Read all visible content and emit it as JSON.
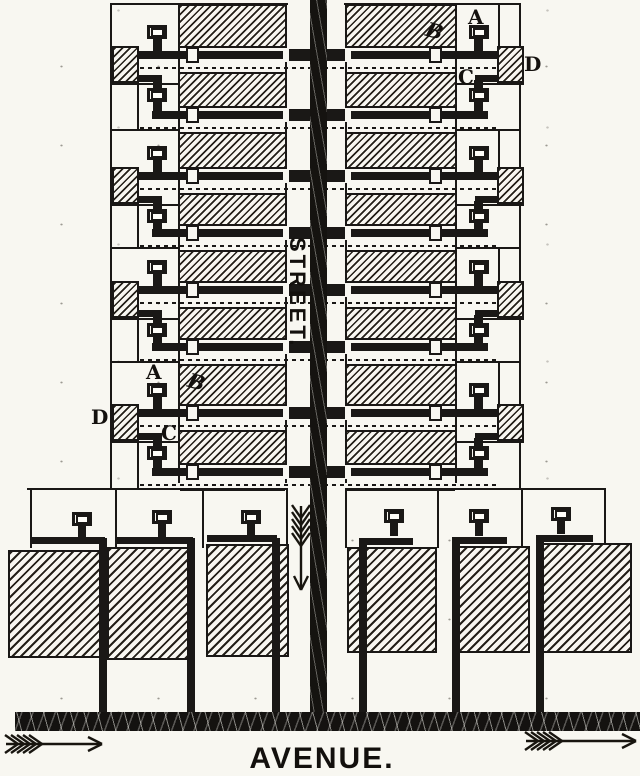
{
  "figure": {
    "street_label": "STREET.",
    "avenue_label": "AVENUE.",
    "ink_color": "#1a1816",
    "paper_color": "#f8f7f1",
    "description": "Plat of distribution mains: transverse mains off a street main, service valve boxes, junction blocks, and avenue-front buildings"
  },
  "callouts": [
    {
      "text": "A",
      "x": 468,
      "y": 7,
      "slanted": false
    },
    {
      "text": "B",
      "x": 426,
      "y": 21,
      "slanted": true
    },
    {
      "text": "C",
      "x": 458,
      "y": 67,
      "slanted": false
    },
    {
      "text": "D",
      "x": 524,
      "y": 54,
      "slanted": false
    },
    {
      "text": "A",
      "x": 146,
      "y": 362,
      "slanted": false
    },
    {
      "text": "B",
      "x": 188,
      "y": 372,
      "slanted": true
    },
    {
      "text": "D",
      "x": 91,
      "y": 407,
      "slanted": false
    },
    {
      "text": "C",
      "x": 161,
      "y": 423,
      "slanted": false
    }
  ],
  "transverse_mains": [
    {
      "y": 55,
      "kind": "primary"
    },
    {
      "y": 115,
      "kind": "branch"
    },
    {
      "y": 176,
      "kind": "primary"
    },
    {
      "y": 233,
      "kind": "branch"
    },
    {
      "y": 290,
      "kind": "primary"
    },
    {
      "y": 347,
      "kind": "branch"
    },
    {
      "y": 413,
      "kind": "primary"
    },
    {
      "y": 472,
      "kind": "branch"
    }
  ],
  "geometry": {
    "canvas": {
      "w": 640,
      "h": 776
    },
    "street": {
      "band_x": 287,
      "band_w": 58,
      "main_x": 310,
      "main_w": 17,
      "main_h": 714
    },
    "bands": {
      "left_x": 178,
      "left_w": 109,
      "right_x": 345,
      "right_w": 112,
      "y": 4,
      "h": 479
    },
    "columns": {
      "left_outer": 110,
      "left_inner": 137,
      "right_inner": 498,
      "right_outer": 519
    },
    "avenue_main": {
      "x": 15,
      "w": 625,
      "y": 712,
      "h": 19
    },
    "pair_lot_lines_y": [
      129,
      247,
      361
    ]
  },
  "avenue_lots": {
    "left": {
      "top_line": {
        "x1": 27,
        "x2": 287,
        "y": 488
      },
      "lot_lines_x": [
        30,
        115,
        202,
        286
      ],
      "boxes": [
        {
          "x": 72,
          "y": 512
        },
        {
          "x": 152,
          "y": 510
        },
        {
          "x": 241,
          "y": 510
        }
      ],
      "headers": [
        {
          "x": 32,
          "w": 73,
          "y": 537
        },
        {
          "x": 116,
          "w": 77,
          "y": 537
        },
        {
          "x": 207,
          "w": 70,
          "y": 535
        }
      ],
      "buildings": [
        {
          "x": 8,
          "y": 550,
          "w": 97,
          "h": 108
        },
        {
          "x": 107,
          "y": 547,
          "w": 86,
          "h": 113
        },
        {
          "x": 206,
          "y": 544,
          "w": 83,
          "h": 113
        }
      ],
      "pipes_x": [
        99,
        187,
        272
      ]
    },
    "right": {
      "top_line": {
        "x1": 345,
        "x2": 605,
        "y": 488
      },
      "lot_lines_x": [
        345,
        437,
        521,
        604
      ],
      "boxes": [
        {
          "x": 384,
          "y": 509
        },
        {
          "x": 469,
          "y": 509
        },
        {
          "x": 551,
          "y": 507
        }
      ],
      "headers": [
        {
          "x": 359,
          "w": 54,
          "y": 538
        },
        {
          "x": 452,
          "w": 55,
          "y": 537
        },
        {
          "x": 536,
          "w": 57,
          "y": 535
        }
      ],
      "buildings": [
        {
          "x": 347,
          "y": 547,
          "w": 90,
          "h": 106
        },
        {
          "x": 454,
          "y": 546,
          "w": 76,
          "h": 107
        },
        {
          "x": 537,
          "y": 543,
          "w": 95,
          "h": 110
        }
      ],
      "pipes_x": [
        359,
        452,
        536
      ]
    }
  },
  "arrows": [
    {
      "name": "street-flow-arrow",
      "direction": "down"
    },
    {
      "name": "avenue-flow-arrow-left",
      "direction": "right"
    },
    {
      "name": "avenue-flow-arrow-right",
      "direction": "right"
    }
  ]
}
